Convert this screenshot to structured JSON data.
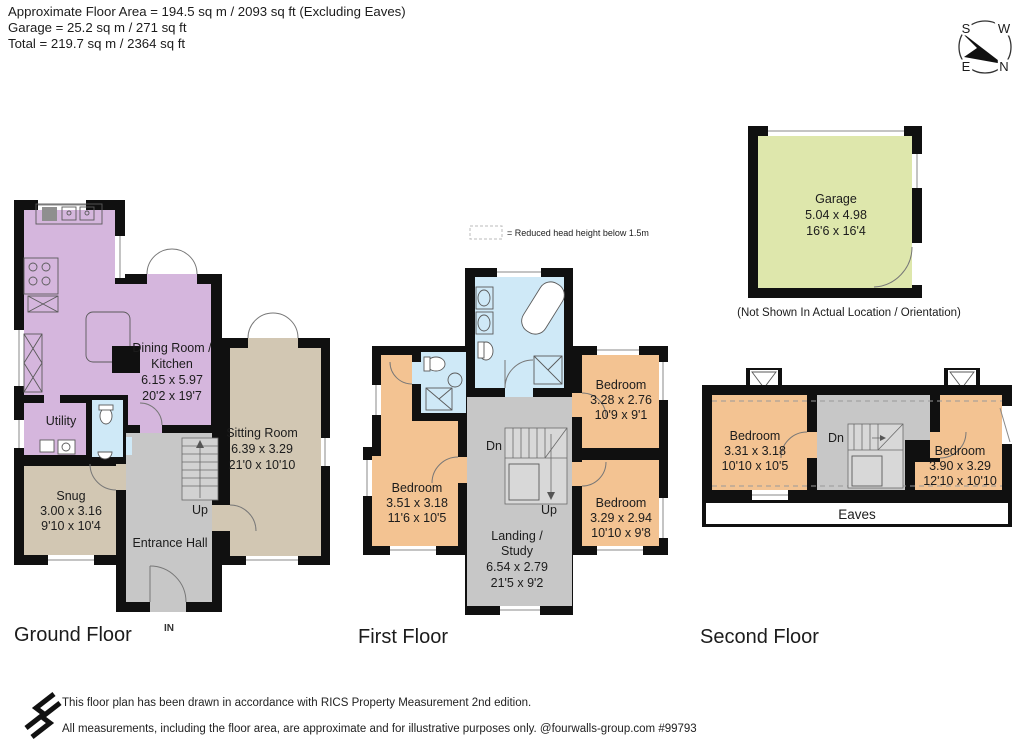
{
  "header": {
    "line1": "Approximate Floor Area = 194.5 sq m / 2093 sq ft (Excluding Eaves)",
    "line2": "Garage = 25.2 sq m / 271 sq ft",
    "line3": "Total = 219.7 sq m / 2364 sq ft"
  },
  "compass": {
    "n": "N",
    "s": "S",
    "e": "E",
    "w": "W"
  },
  "legend": {
    "reduced_head_height": "= Reduced head height below 1.5m"
  },
  "garage": {
    "title": "Garage",
    "dims_m": "5.04 x 4.98",
    "dims_ft": "16'6 x 16'4",
    "note": "(Not Shown In Actual Location / Orientation)"
  },
  "ground_floor": {
    "label": "Ground Floor",
    "dining_kitchen": {
      "name_line1": "Dining Room /",
      "name_line2": "Kitchen",
      "dims_m": "6.15 x 5.97",
      "dims_ft": "20'2 x 19'7"
    },
    "utility": {
      "name": "Utility"
    },
    "snug": {
      "name": "Snug",
      "dims_m": "3.00 x 3.16",
      "dims_ft": "9'10 x 10'4"
    },
    "sitting_room": {
      "name": "Sitting Room",
      "dims_m": "6.39 x 3.29",
      "dims_ft": "21'0 x 10'10"
    },
    "entrance_hall": {
      "name": "Entrance Hall"
    },
    "stairs_up": "Up",
    "entrance": "IN"
  },
  "first_floor": {
    "label": "First Floor",
    "bedroom_left": {
      "name": "Bedroom",
      "dims_m": "3.51 x 3.18",
      "dims_ft": "11'6 x 10'5"
    },
    "bedroom_top_right": {
      "name": "Bedroom",
      "dims_m": "3.28 x 2.76",
      "dims_ft": "10'9 x 9'1"
    },
    "bedroom_bottom_right": {
      "name": "Bedroom",
      "dims_m": "3.29 x 2.94",
      "dims_ft": "10'10 x 9'8"
    },
    "landing_study": {
      "name_line1": "Landing /",
      "name_line2": "Study",
      "dims_m": "6.54 x 2.79",
      "dims_ft": "21'5 x 9'2"
    },
    "stairs_down": "Dn",
    "stairs_up": "Up"
  },
  "second_floor": {
    "label": "Second Floor",
    "bedroom_left": {
      "name": "Bedroom",
      "dims_m": "3.31 x 3.18",
      "dims_ft": "10'10 x 10'5"
    },
    "bedroom_right": {
      "name": "Bedroom",
      "dims_m": "3.90 x 3.29",
      "dims_ft": "12'10 x 10'10"
    },
    "stairs_down": "Dn",
    "eaves": "Eaves"
  },
  "footer": {
    "line1": "This floor plan has been drawn in accordance with RICS Property Measurement 2nd edition.",
    "line2": "All measurements, including the floor area, are approximate and for illustrative purposes only. @fourwalls-group.com #99793"
  },
  "colors": {
    "kitchen_purple": "#d5b6dd",
    "bathroom_blue": "#cfe9f7",
    "reception_tan": "#d2c7b3",
    "hall_grey": "#c7c7c7",
    "bedroom_orange": "#f3c392",
    "garage_green": "#dee7ac",
    "stairs_grey": "#d2d2d2",
    "wall_black": "#101010"
  }
}
